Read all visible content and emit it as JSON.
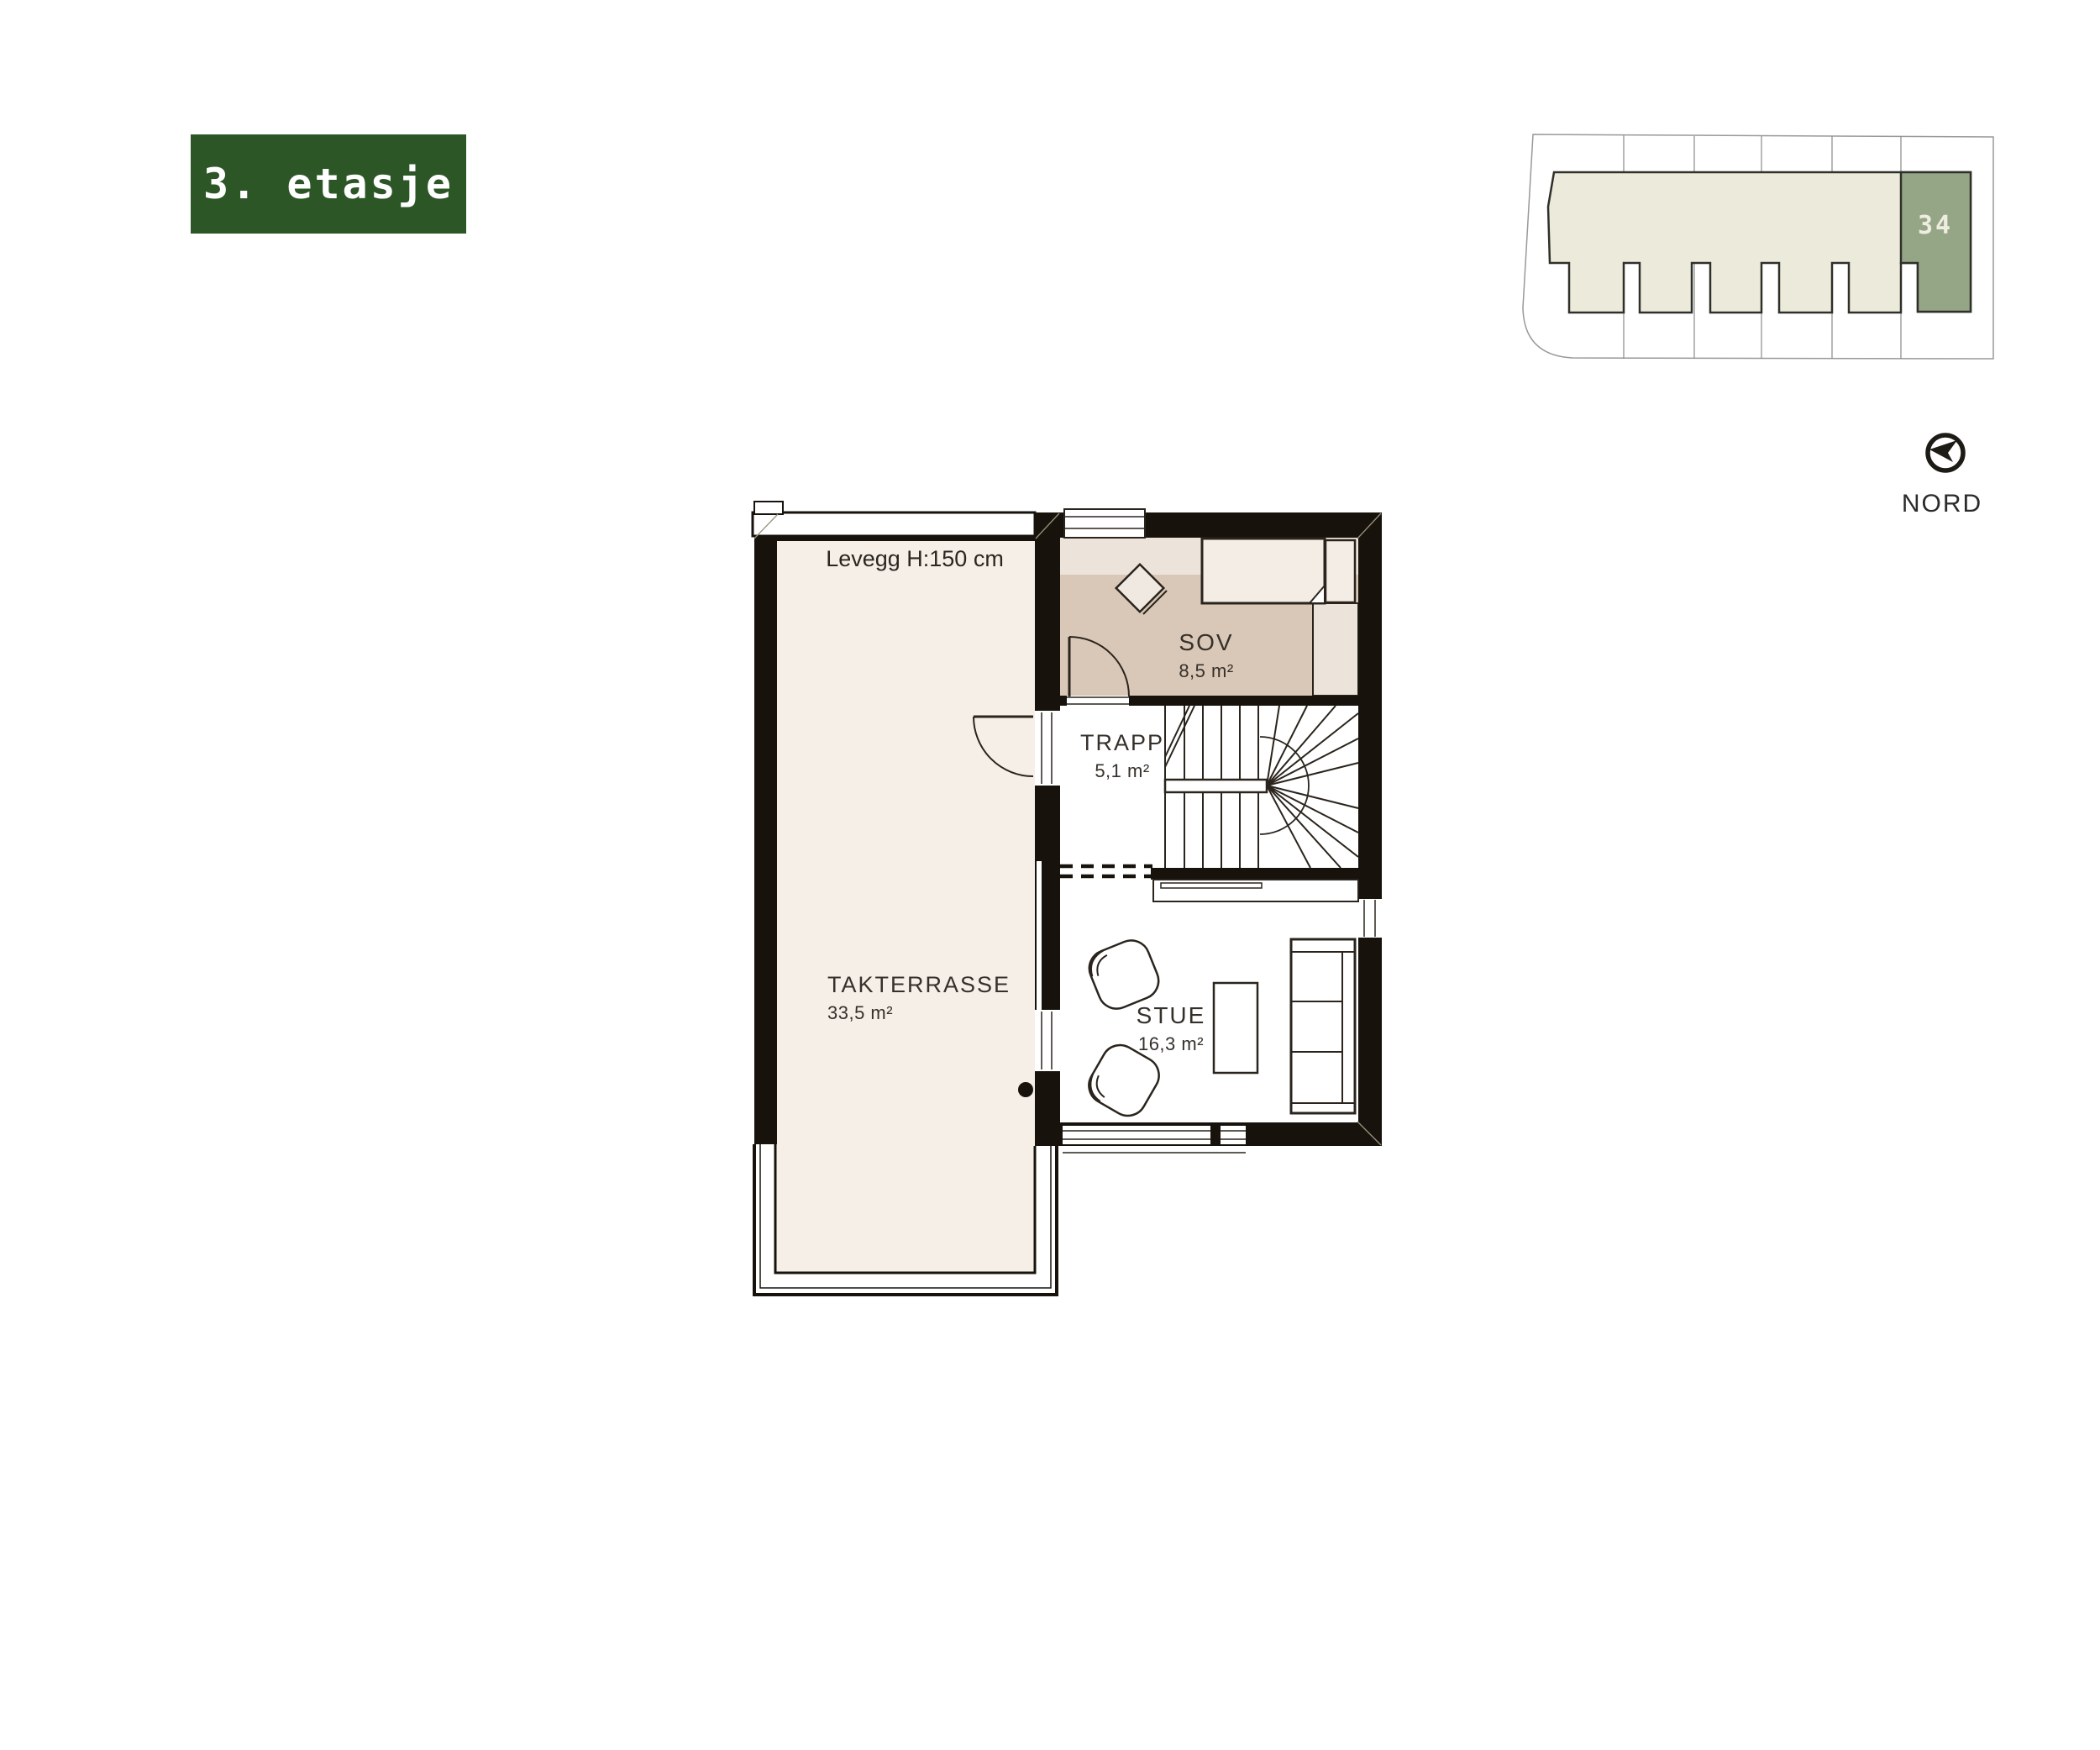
{
  "page": {
    "background": "#ffffff",
    "wall_color": "#17130c",
    "line_color": "#2a241d"
  },
  "floor_badge": {
    "label": "3. etasje",
    "bg_color": "#2d5627",
    "text_color": "#ffffff"
  },
  "site_plan": {
    "unit_number": "34",
    "unit_color": "#95a687",
    "building_color": "#eceadb",
    "outline_color": "#30302a",
    "parcel_line_color": "#999999",
    "lot_count": 6
  },
  "compass": {
    "label": "NORD"
  },
  "floor_plan": {
    "rooms": {
      "takterrasse": {
        "name": "TAKTERRASSE",
        "area": "33,5 m²",
        "floor_color": "#f5efe8"
      },
      "sov": {
        "name": "SOV",
        "area": "8,5 m²",
        "floor_color": "#d9c8b7"
      },
      "trapp": {
        "name": "TRAPP",
        "area": "5,1 m²",
        "floor_color": "#ffffff"
      },
      "stue": {
        "name": "STUE",
        "area": "16,3 m²",
        "floor_color": "#ffffff"
      }
    },
    "annotations": {
      "levegg": {
        "text": "Levegg H:150 cm"
      }
    }
  }
}
